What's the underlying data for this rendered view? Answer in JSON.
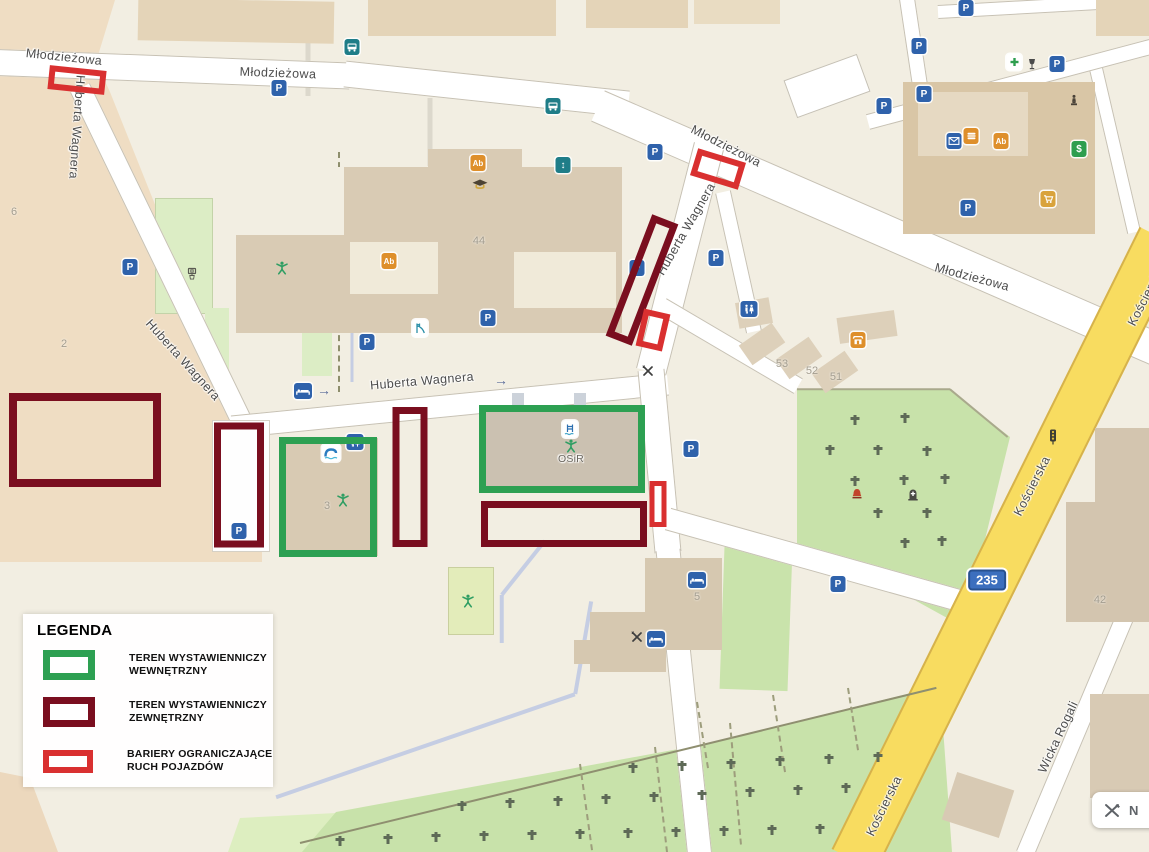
{
  "legend": {
    "title": "LEGENDA",
    "items": [
      {
        "type": "inner",
        "line1": "TEREN WYSTAWIENNICZY",
        "line2": "WEWNĘTRZNY"
      },
      {
        "type": "outer",
        "line1": "TEREN WYSTAWIENNICZY",
        "line2": "ZEWNĘTRZNY"
      },
      {
        "type": "barrier",
        "line1": "BARIERY OGRANICZAJĄCE",
        "line2": "RUCH POJAZDÓW"
      }
    ]
  },
  "controls": {
    "edit_label": "N"
  },
  "map": {
    "colors": {
      "exhibition_inner": "#2da052",
      "exhibition_outer": "#7a0e1f",
      "vehicle_barrier": "#d93030",
      "primary_road": "#f8dc60",
      "route_badge_bg": "#3c6fbe"
    },
    "route_badge": {
      "text": "235",
      "x": 987,
      "y": 580
    },
    "street_labels": [
      {
        "text": "Młodzieżowa",
        "x": 64,
        "y": 57,
        "rot": 6
      },
      {
        "text": "Młodzieżowa",
        "x": 278,
        "y": 73,
        "rot": 2
      },
      {
        "text": "Młodzieżowa",
        "x": 726,
        "y": 146,
        "rot": 27
      },
      {
        "text": "Młodzieżowa",
        "x": 972,
        "y": 277,
        "rot": 15
      },
      {
        "text": "Huberta Wagnera",
        "x": 77,
        "y": 127,
        "rot": 94
      },
      {
        "text": "Huberta Wagnera",
        "x": 183,
        "y": 360,
        "rot": 48
      },
      {
        "text": "Huberta Wagnera",
        "x": 422,
        "y": 381,
        "rot": -5
      },
      {
        "text": "Huberta Wagnera",
        "x": 686,
        "y": 229,
        "rot": -60
      },
      {
        "text": "Kościerska",
        "x": 1032,
        "y": 486,
        "rot": -63
      },
      {
        "text": "Kościerska",
        "x": 884,
        "y": 806,
        "rot": -64
      },
      {
        "text": "Kościerska",
        "x": 1146,
        "y": 296,
        "rot": -63
      },
      {
        "text": "Wicka Rogali",
        "x": 1058,
        "y": 737,
        "rot": -65
      },
      {
        "text": "OSiR",
        "x": 571,
        "y": 459,
        "rot": 0,
        "small": true
      }
    ],
    "building_numbers": [
      {
        "text": "44",
        "x": 479,
        "y": 241
      },
      {
        "text": "3",
        "x": 327,
        "y": 506
      },
      {
        "text": "5",
        "x": 697,
        "y": 597
      },
      {
        "text": "53",
        "x": 782,
        "y": 364
      },
      {
        "text": "52",
        "x": 812,
        "y": 371
      },
      {
        "text": "51",
        "x": 836,
        "y": 377
      },
      {
        "text": "42",
        "x": 1100,
        "y": 600
      },
      {
        "text": "2",
        "x": 64,
        "y": 344
      },
      {
        "text": "6",
        "x": 14,
        "y": 212
      }
    ],
    "icons": [
      {
        "name": "parking-icon",
        "x": 279,
        "y": 88
      },
      {
        "name": "parking-icon",
        "x": 130,
        "y": 267
      },
      {
        "name": "parking-icon",
        "x": 367,
        "y": 342
      },
      {
        "name": "parking-icon",
        "x": 488,
        "y": 318
      },
      {
        "name": "parking-icon",
        "x": 239,
        "y": 531
      },
      {
        "name": "parking-icon",
        "x": 637,
        "y": 268
      },
      {
        "name": "parking-icon",
        "x": 716,
        "y": 258
      },
      {
        "name": "parking-icon",
        "x": 655,
        "y": 152
      },
      {
        "name": "parking-icon",
        "x": 966,
        "y": 8
      },
      {
        "name": "parking-icon",
        "x": 919,
        "y": 46
      },
      {
        "name": "parking-icon",
        "x": 924,
        "y": 94
      },
      {
        "name": "parking-icon",
        "x": 884,
        "y": 106
      },
      {
        "name": "parking-icon",
        "x": 1057,
        "y": 64
      },
      {
        "name": "parking-icon",
        "x": 968,
        "y": 208
      },
      {
        "name": "parking-icon",
        "x": 838,
        "y": 584
      },
      {
        "name": "parking-icon",
        "x": 691,
        "y": 449
      },
      {
        "name": "bus-stop-icon",
        "x": 352,
        "y": 47
      },
      {
        "name": "bus-stop-icon",
        "x": 553,
        "y": 106
      },
      {
        "name": "elevator-icon",
        "x": 563,
        "y": 165
      },
      {
        "name": "toilets-icon",
        "x": 749,
        "y": 309
      },
      {
        "name": "toilets-icon",
        "x": 355,
        "y": 442
      },
      {
        "name": "pharmacy-icon",
        "x": 1014,
        "y": 62
      },
      {
        "name": "wine-bar-icon",
        "x": 1032,
        "y": 64
      },
      {
        "name": "statue-icon",
        "x": 1074,
        "y": 100
      },
      {
        "name": "mail-icon",
        "x": 954,
        "y": 141
      },
      {
        "name": "fast-food-icon",
        "x": 971,
        "y": 136
      },
      {
        "name": "school-icon",
        "x": 478,
        "y": 163
      },
      {
        "name": "school-icon",
        "x": 389,
        "y": 261
      },
      {
        "name": "school-icon",
        "x": 1001,
        "y": 141
      },
      {
        "name": "graduation-cap-icon",
        "x": 480,
        "y": 185
      },
      {
        "name": "currency-exchange-icon",
        "x": 1079,
        "y": 149
      },
      {
        "name": "shopping-cart-icon",
        "x": 1048,
        "y": 199
      },
      {
        "name": "kiosk-icon",
        "x": 858,
        "y": 340
      },
      {
        "name": "restaurant-icon",
        "x": 648,
        "y": 371
      },
      {
        "name": "restaurant-icon",
        "x": 637,
        "y": 637
      },
      {
        "name": "hotel-icon",
        "x": 697,
        "y": 580
      },
      {
        "name": "hotel-icon",
        "x": 656,
        "y": 639
      },
      {
        "name": "hotel-icon",
        "x": 303,
        "y": 391
      },
      {
        "name": "oneway-arrow-icon",
        "x": 324,
        "y": 390
      },
      {
        "name": "oneway-arrow-icon",
        "x": 501,
        "y": 380
      },
      {
        "name": "water-slide-icon",
        "x": 331,
        "y": 453
      },
      {
        "name": "pool-ladder-icon",
        "x": 570,
        "y": 429
      },
      {
        "name": "sports-person-icon",
        "x": 282,
        "y": 268
      },
      {
        "name": "sports-person-icon",
        "x": 343,
        "y": 500
      },
      {
        "name": "sports-person-icon",
        "x": 571,
        "y": 446
      },
      {
        "name": "sports-person-icon",
        "x": 468,
        "y": 601
      },
      {
        "name": "basketball-court-icon",
        "x": 192,
        "y": 274
      },
      {
        "name": "playground-icon",
        "x": 420,
        "y": 328
      },
      {
        "name": "traffic-light-icon",
        "x": 1053,
        "y": 437
      },
      {
        "name": "bell-icon",
        "x": 857,
        "y": 494
      },
      {
        "name": "memorial-icon",
        "x": 913,
        "y": 495
      }
    ],
    "overlays": [
      {
        "type": "barrier",
        "x": 77,
        "y": 80,
        "w": 57,
        "h": 24,
        "rot": 6,
        "bw": 6
      },
      {
        "type": "barrier",
        "x": 718,
        "y": 169,
        "w": 50,
        "h": 28,
        "rot": 17,
        "bw": 6
      },
      {
        "type": "outer",
        "x": 642,
        "y": 280,
        "w": 28,
        "h": 130,
        "rot": 21,
        "bw": 7
      },
      {
        "type": "barrier",
        "x": 653,
        "y": 330,
        "w": 27,
        "h": 38,
        "rot": 13,
        "bw": 6
      },
      {
        "type": "outer",
        "x": 85,
        "y": 440,
        "w": 152,
        "h": 94,
        "rot": 0,
        "bw": 8
      },
      {
        "type": "outer",
        "x": 239,
        "y": 485,
        "w": 50,
        "h": 125,
        "rot": 0,
        "bw": 7
      },
      {
        "type": "inner",
        "x": 328,
        "y": 497,
        "w": 98,
        "h": 120,
        "rot": 0,
        "bw": 7
      },
      {
        "type": "outer",
        "x": 410,
        "y": 477,
        "w": 35,
        "h": 140,
        "rot": 0,
        "bw": 7
      },
      {
        "type": "inner",
        "x": 562,
        "y": 449,
        "w": 166,
        "h": 88,
        "rot": 0,
        "bw": 7
      },
      {
        "type": "outer",
        "x": 564,
        "y": 524,
        "w": 166,
        "h": 46,
        "rot": 0,
        "bw": 7
      },
      {
        "type": "barrier",
        "x": 658,
        "y": 504,
        "w": 17,
        "h": 46,
        "rot": 0,
        "bw": 5
      }
    ],
    "cemetery_crosses": [
      [
        855,
        420
      ],
      [
        905,
        418
      ],
      [
        830,
        450
      ],
      [
        878,
        450
      ],
      [
        927,
        451
      ],
      [
        855,
        481
      ],
      [
        904,
        480
      ],
      [
        945,
        479
      ],
      [
        878,
        513
      ],
      [
        927,
        513
      ],
      [
        905,
        543
      ],
      [
        942,
        541
      ],
      [
        633,
        768
      ],
      [
        682,
        766
      ],
      [
        731,
        764
      ],
      [
        780,
        761
      ],
      [
        829,
        759
      ],
      [
        878,
        757
      ],
      [
        462,
        806
      ],
      [
        510,
        803
      ],
      [
        558,
        801
      ],
      [
        606,
        799
      ],
      [
        654,
        797
      ],
      [
        702,
        795
      ],
      [
        750,
        792
      ],
      [
        798,
        790
      ],
      [
        846,
        788
      ],
      [
        340,
        841
      ],
      [
        388,
        839
      ],
      [
        436,
        837
      ],
      [
        484,
        836
      ],
      [
        532,
        835
      ],
      [
        580,
        834
      ],
      [
        628,
        833
      ],
      [
        676,
        832
      ],
      [
        724,
        831
      ],
      [
        772,
        830
      ],
      [
        820,
        829
      ]
    ]
  }
}
